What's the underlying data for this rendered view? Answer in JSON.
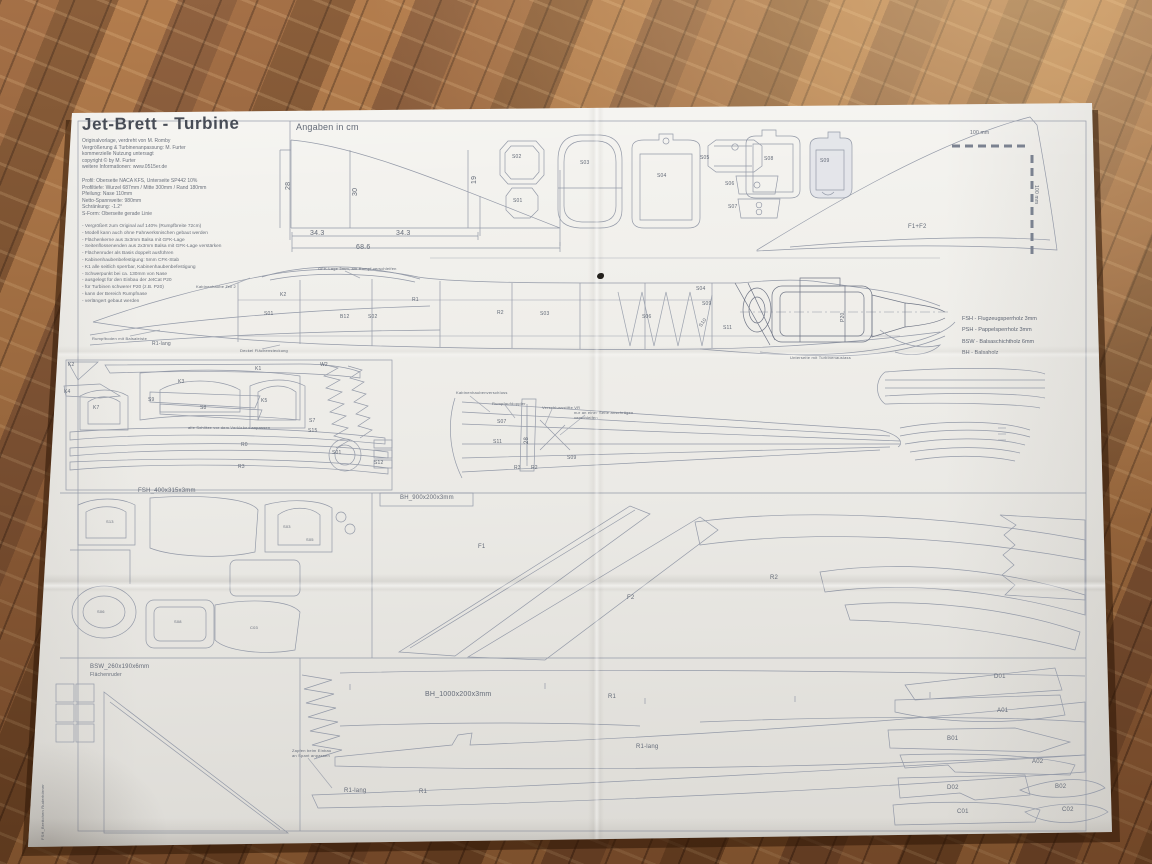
{
  "title_block": {
    "title": "Jet-Brett - Turbine",
    "info_lines": [
      "Originalvorlage, verdreht von M. Romby",
      "Vergrößerung & Turbinenanpassung: M. Furter",
      "kommerzielle Nutzung untersagt",
      "copyright © by M. Furter",
      "weitere Informationen: www.0515er.de"
    ],
    "spec_lines": [
      "Profil: Oberseite NACA KFS, Unterseite SP442 10%",
      "Profiltiefe: Wurzel 687mm / Mitte 300mm / Rand 180mm",
      "Pfeilung: Nase 110mm",
      "Netto-Spannweite: 980mm",
      "Schränkung: -1.2°",
      "S-Form: Oberseite gerade Linie"
    ],
    "notes_lines": [
      "- Vergrößert zum Original auf 140% (Rumpfbreite 72cm)",
      "- Modell kann auch ohne Fahrwerksnischen gebaut werden",
      "- Flächenkerne aus 3x3mm Balsa mit GFK-Lage",
      "- Seitenflossenenden aus 2x3mm Balsa mit GFK-Lage verstärken",
      "- Flächenruder als Basis doppelt ausführen",
      "- Kabinenhaubenbefestigung: 5mm CFK-Stab",
      "- K1 alle seitlich sperrbar, Kabinenhaubenbefestigung",
      "- Schwerpunkt bei ca. 130mm von Nase",
      "- ausgelegt für den Einbau der JetCat P20",
      "- für Turbinen schwerer P20 (z.B. P20)",
      "- kann der Bereich Rumpfnase",
      "- verlängert gebaut werden"
    ]
  },
  "legend": {
    "lines": [
      "FSH - Flugzeugsperrholz 3mm",
      "PSH - Pappelsperrholz 3mm",
      "BSW - Balsaschichtholz 6mm",
      "BH - Balsaholz"
    ]
  },
  "labels": {
    "angaben": "Angaben in cm",
    "dim_28": "28",
    "dim_30": "30",
    "dim_19": "19",
    "dim_343a": "34.3",
    "dim_343b": "34.3",
    "dim_686": "68.6",
    "scale_top": "100 mm",
    "scale_right": "100 mm",
    "former_s02": "S02",
    "former_s01": "S01",
    "former_s03": "S03",
    "former_s04": "S04",
    "former_s05": "S05",
    "former_s06": "S06",
    "former_s07": "S07",
    "former_s08": "S08",
    "former_s09": "S09",
    "fin": "F1+F2",
    "fus_k2": "K2",
    "fus_s01": "S01",
    "fus_b12": "B12",
    "fus_s02": "S02",
    "fus_r1": "R1",
    "fus_r2": "R2",
    "fus_s03": "S03",
    "fus_s04": "S04",
    "fus_s09": "S09",
    "fus_s10": "S10",
    "fus_s06": "S06",
    "fus_s11": "S11",
    "fus_r1lang": "R1-lang",
    "fus_p20": "P20",
    "ann_canopy": "Kabinenhaube Teil 2",
    "ann_gfk": "GFK-Lage 3mm, am Rumpf verschleifen",
    "ann_boden": "Rumpfboden mit Balsaleiste",
    "ann_deckel": "Deckel Flächensteckung",
    "ann_unterseite": "Unterseite mit Turbinenauslass",
    "lp_k2": "K2",
    "lp_k1": "K1",
    "lp_k3": "K3",
    "lp_k4": "K4",
    "lp_k5": "K5",
    "lp_k7": "K7",
    "lp_w2": "W2",
    "lp_s8": "S8",
    "lp_s9": "S9",
    "lp_s7": "S7",
    "lp_s15": "S15",
    "lp_s01": "S01",
    "lp_s12": "S12",
    "lp_r0": "R0",
    "lp_r3": "R3",
    "lp_note": "alle Schlitze vor dem Verkleben anpassen",
    "wv_s07": "S07",
    "wv_s11": "S11",
    "wv_s09": "S09",
    "wv_r3": "R3",
    "wv_r2": "R2",
    "wv_28": "28",
    "wv_a1": "Kabinenhaubenverschluss",
    "wv_a2": "Rumpfaufdoppler",
    "wv_a3": "Verschlussstifte VR",
    "wv_a4": "nur an einer Seite anschrägen",
    "wv_a5": "verschleifen",
    "panel_fsh": "FSH_400x315x3mm",
    "panel_bh900": "BH_900x200x3mm",
    "panel_bsw": "BSW_260x190x6mm",
    "panel_bsw_sub": "Flächenruder",
    "panel_bh1000": "BH_1000x200x3mm",
    "fsh_s13": "S13",
    "fsh_s03": "S03",
    "fsh_s05": "S05",
    "fsh_s06": "S06",
    "fsh_s08": "S08",
    "fsh_c03": "C03",
    "bh9_f1": "F1",
    "bh9_f2": "F2",
    "bh9_r2": "R2",
    "bh10_r1": "R1",
    "bh10_r1lang": "R1-lang",
    "bh10_r1lang2": "R1-lang",
    "bh10_r1b": "R1",
    "bh10_note1": "Zapfen beim Einbau",
    "bh10_note2": "an Spant anpassen",
    "edge_note": "FSH_Brettchen  Ruderhörner",
    "pr_d01": "D01",
    "pr_a01": "A01",
    "pr_b01": "B01",
    "pr_a02": "A02",
    "pr_d02": "D02",
    "pr_b02": "B02",
    "pr_c01": "C01",
    "pr_c02": "C02"
  }
}
